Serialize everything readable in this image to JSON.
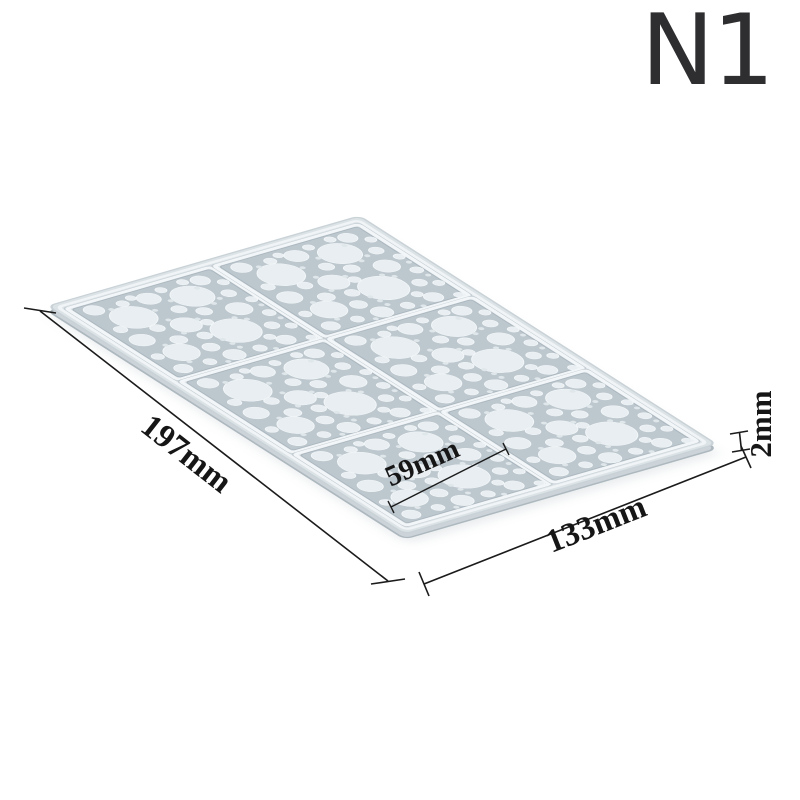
{
  "variant_label": "N1",
  "dimensions": {
    "length": "197mm",
    "width": "133mm",
    "cell": "59mm",
    "thickness": "2mm"
  },
  "colors": {
    "background": "#ffffff",
    "mat_face": "#dce3e7",
    "mat_bubble": "#e8eef1",
    "mat_recess_floor": "#bdc7ce",
    "mat_side": "#ccd4d9",
    "ridge_highlight": "#f2f6f8",
    "dimension_ink": "#161616",
    "variant_ink": "#2e2e30"
  }
}
